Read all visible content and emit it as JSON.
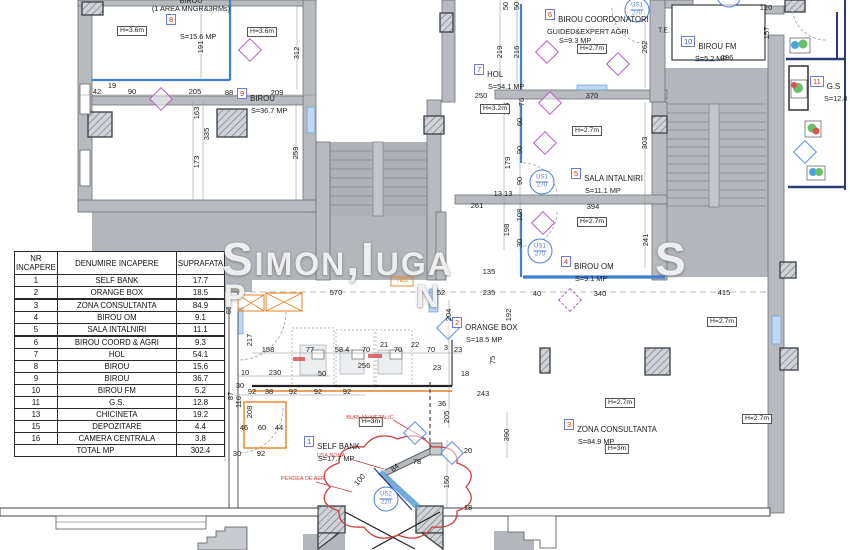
{
  "watermark": {
    "line1": "Simon,Iuga",
    "trail": "S",
    "frag1": "P",
    "frag2": "N"
  },
  "legend_table": {
    "headers": [
      "NR\nINCAPERE",
      "DENUMIRE INCAPERE",
      "SUPRAFATA"
    ],
    "rows": [
      [
        "1",
        "SELF BANK",
        "17.7"
      ],
      [
        "2",
        "ORANGE BOX",
        "18.5"
      ],
      [
        "3",
        "ZONA CONSULTANTA",
        "84.9"
      ],
      [
        "4",
        "BIROU OM",
        "9.1"
      ],
      [
        "5",
        "SALA INTALNIRI",
        "11.1"
      ],
      [
        "6",
        "BIROU COORD & AGRI",
        "9.3"
      ],
      [
        "7",
        "HOL",
        "54.1"
      ],
      [
        "8",
        "BIROU",
        "15.6"
      ],
      [
        "9",
        "BIROU",
        "36.7"
      ],
      [
        "10",
        "BIROU FM",
        "5.2"
      ],
      [
        "11",
        "G.S.",
        "12.8"
      ],
      [
        "13",
        "CHICINETA",
        "19.2"
      ],
      [
        "15",
        "DEPOZITARE",
        "4.4"
      ],
      [
        "16",
        "CAMERA CENTRALA",
        "3.8"
      ]
    ],
    "thick_rows": [
      2,
      5
    ],
    "total_label": "TOTAL MP",
    "total_value": "302.4"
  },
  "rooms": [
    {
      "num": "8",
      "name": "",
      "pre": [
        "BIROU",
        "(1 AREA MNGR&3RMs)"
      ],
      "area": "S=15.6 MP",
      "clr": "red",
      "x": 166,
      "y": 14
    },
    {
      "num": "9",
      "name": "BIROU",
      "area": "S=36.7 MP",
      "clr": "red",
      "x": 237,
      "y": 88
    },
    {
      "num": "7",
      "name": "HOL",
      "area": "S=54.1 MP",
      "clr": "blue",
      "x": 474,
      "y": 64
    },
    {
      "num": "6",
      "name": "BIROU COORDONATORI",
      "sub": "GUIDED&EXPERT AGRI",
      "area": "S=9.3 MP",
      "clr": "red",
      "x": 545,
      "y": 9
    },
    {
      "num": "5",
      "name": "SALA INTALNIRI",
      "area": "S=11.1 MP",
      "clr": "red",
      "x": 571,
      "y": 168
    },
    {
      "num": "4",
      "name": "BIROU OM",
      "area": "S=9.1 MP",
      "clr": "red",
      "x": 561,
      "y": 256
    },
    {
      "num": "10",
      "name": "BIROU FM",
      "area": "S=5.2 MP",
      "clr": "blue",
      "x": 681,
      "y": 36
    },
    {
      "num": "11",
      "name": "G.S",
      "area": "S=12.8 MP",
      "clr": "red",
      "x": 810,
      "y": 76
    },
    {
      "num": "2",
      "name": "ORANGE BOX",
      "area": "S=18.5 MP",
      "clr": "red",
      "x": 452,
      "y": 317
    },
    {
      "num": "1",
      "name": "SELF BANK",
      "area": "S=17.7 MP",
      "clr": "blue",
      "x": 304,
      "y": 436
    },
    {
      "num": "3",
      "name": "ZONA CONSULTANTA",
      "area": "S=84.9 MP",
      "clr": "red",
      "x": 564,
      "y": 419
    }
  ],
  "height_labels": [
    {
      "t": "H=3.6m",
      "x": 132,
      "y": 31
    },
    {
      "t": "H=3.6m",
      "x": 262,
      "y": 32
    },
    {
      "t": "H=2.7m",
      "x": 592,
      "y": 49
    },
    {
      "t": "H=3.2m",
      "x": 495,
      "y": 109
    },
    {
      "t": "H=2.7m",
      "x": 587,
      "y": 131
    },
    {
      "t": "H=2.7m",
      "x": 592,
      "y": 222
    },
    {
      "t": "H=2.7m",
      "x": 722,
      "y": 322
    },
    {
      "t": "H=2.7m",
      "x": 620,
      "y": 403
    },
    {
      "t": "H=2.7m",
      "x": 757,
      "y": 419
    },
    {
      "t": "H=3m",
      "x": 617,
      "y": 449
    },
    {
      "t": "H=3m",
      "x": 371,
      "y": 422
    }
  ],
  "dims": [
    [
      "42",
      97,
      92
    ],
    [
      "19",
      112,
      86
    ],
    [
      "90",
      132,
      92
    ],
    [
      "205",
      195,
      92
    ],
    [
      "88",
      229,
      93
    ],
    [
      "209",
      277,
      93
    ],
    [
      "191",
      201,
      47,
      "v"
    ],
    [
      "312",
      297,
      53,
      "v"
    ],
    [
      "163",
      197,
      113,
      "v"
    ],
    [
      "335",
      207,
      134,
      "v"
    ],
    [
      "173",
      197,
      162,
      "v"
    ],
    [
      "259",
      296,
      153,
      "v"
    ],
    [
      "50",
      506,
      6,
      "v"
    ],
    [
      "50",
      517,
      6,
      "v"
    ],
    [
      "219",
      500,
      52,
      "v"
    ],
    [
      "216",
      517,
      52,
      "v"
    ],
    [
      "262",
      645,
      47,
      "v"
    ],
    [
      "157",
      767,
      33,
      "v"
    ],
    [
      "120",
      766,
      8
    ],
    [
      "296",
      727,
      58
    ],
    [
      "250",
      481,
      96
    ],
    [
      "370",
      592,
      96
    ],
    [
      "76",
      522,
      102,
      "v"
    ],
    [
      "136",
      507,
      109,
      "v"
    ],
    [
      "303",
      645,
      143,
      "v"
    ],
    [
      "241",
      646,
      240,
      "v"
    ],
    [
      "60",
      520,
      122,
      "v"
    ],
    [
      "90",
      520,
      150,
      "v"
    ],
    [
      "179",
      508,
      163,
      "v"
    ],
    [
      "90",
      520,
      181,
      "v"
    ],
    [
      "108",
      520,
      215,
      "v"
    ],
    [
      "198",
      507,
      230,
      "v"
    ],
    [
      "30",
      520,
      243,
      "v"
    ],
    [
      "13 13",
      503,
      194
    ],
    [
      "394",
      593,
      207
    ],
    [
      "261",
      477,
      206
    ],
    [
      "135",
      489,
      272
    ],
    [
      "570",
      336,
      293
    ],
    [
      "52",
      441,
      293
    ],
    [
      "235",
      489,
      293
    ],
    [
      "40",
      537,
      294
    ],
    [
      "340",
      600,
      294
    ],
    [
      "415",
      724,
      293
    ],
    [
      "204",
      449,
      315,
      "v"
    ],
    [
      "192",
      509,
      315,
      "v"
    ],
    [
      "65",
      229,
      310,
      "v"
    ],
    [
      "217",
      250,
      340,
      "v"
    ],
    [
      "158",
      268,
      350
    ],
    [
      "77",
      310,
      350
    ],
    [
      "58.4",
      342,
      350
    ],
    [
      "70",
      366,
      350
    ],
    [
      "21",
      384,
      345
    ],
    [
      "70",
      398,
      350
    ],
    [
      "22",
      415,
      345
    ],
    [
      "70",
      431,
      350
    ],
    [
      "3",
      446,
      348
    ],
    [
      "23",
      458,
      350
    ],
    [
      "256",
      364,
      366
    ],
    [
      "23",
      437,
      368
    ],
    [
      "10",
      245,
      373
    ],
    [
      "230",
      275,
      373
    ],
    [
      "50",
      322,
      374
    ],
    [
      "30",
      240,
      386
    ],
    [
      "92",
      252,
      392
    ],
    [
      "38",
      269,
      392
    ],
    [
      "92",
      293,
      392
    ],
    [
      "92",
      318,
      392
    ],
    [
      "92",
      347,
      392
    ],
    [
      "87",
      231,
      396,
      "v"
    ],
    [
      "116",
      239,
      402,
      "v"
    ],
    [
      "75",
      493,
      360,
      "v"
    ],
    [
      "18",
      465,
      374
    ],
    [
      "243",
      483,
      394
    ],
    [
      "36",
      442,
      404
    ],
    [
      "205",
      447,
      417,
      "v"
    ],
    [
      "46",
      244,
      428
    ],
    [
      "60",
      262,
      428
    ],
    [
      "44",
      279,
      428
    ],
    [
      "208",
      250,
      412,
      "v"
    ],
    [
      "30",
      237,
      454
    ],
    [
      "92",
      261,
      454
    ],
    [
      "390",
      507,
      435,
      "v"
    ],
    [
      "150",
      447,
      482,
      "v"
    ],
    [
      "20",
      468,
      451
    ],
    [
      "18",
      468,
      508
    ],
    [
      "84",
      395,
      468,
      "r40"
    ],
    [
      "100",
      360,
      480,
      "r50"
    ],
    [
      "78",
      417,
      462
    ]
  ],
  "door_tags": [
    {
      "l1": "US1",
      "l2": "270",
      "x": 542,
      "y": 182
    },
    {
      "l1": "US1",
      "l2": "270",
      "x": 540,
      "y": 251
    },
    {
      "l1": "US1",
      "l2": "270",
      "x": 637,
      "y": 10
    },
    {
      "l1": "US1",
      "l2": "270",
      "x": 729,
      "y": -5
    },
    {
      "l1": "US2",
      "l2": "220",
      "x": 386,
      "y": 499
    }
  ],
  "red_notes": [
    {
      "t": "USA NOUA",
      "x": 331,
      "y": 456
    },
    {
      "t": "PERDEA DE AER",
      "x": 303,
      "y": 479
    },
    {
      "t": "BURLAN METALIC",
      "x": 370,
      "y": 418
    }
  ],
  "misc_labels": [
    {
      "t": "T.E.",
      "x": 664,
      "y": 31,
      "cls": "te"
    },
    {
      "t": "TEG",
      "x": 402,
      "y": 281,
      "cls": "teg"
    }
  ],
  "symbols": {
    "diamonds": [
      {
        "x": 161,
        "y": 99,
        "c": "p"
      },
      {
        "x": 250,
        "y": 50,
        "c": "p"
      },
      {
        "x": 547,
        "y": 52,
        "c": "p"
      },
      {
        "x": 618,
        "y": 64,
        "c": "p"
      },
      {
        "x": 550,
        "y": 103,
        "c": "p"
      },
      {
        "x": 545,
        "y": 143,
        "c": "p"
      },
      {
        "x": 543,
        "y": 223,
        "c": "p"
      },
      {
        "x": 570,
        "y": 300,
        "c": "p",
        "dash": true
      },
      {
        "x": 805,
        "y": 152,
        "c": "b"
      },
      {
        "x": 448,
        "y": 328,
        "c": "b"
      },
      {
        "x": 452,
        "y": 453,
        "c": "b"
      },
      {
        "x": 415,
        "y": 433,
        "c": "b"
      }
    ]
  },
  "colors": {
    "wall_gray": "#b7bbbf",
    "slab_gray": "#b3b7bb",
    "blue_wall": "#3f7fd4",
    "navy": "#2c3a78",
    "orange": "#e8821e",
    "red_annotation": "#d04040",
    "purple_symbol": "#b15fc4",
    "window_blue": "#bdd7f5"
  }
}
